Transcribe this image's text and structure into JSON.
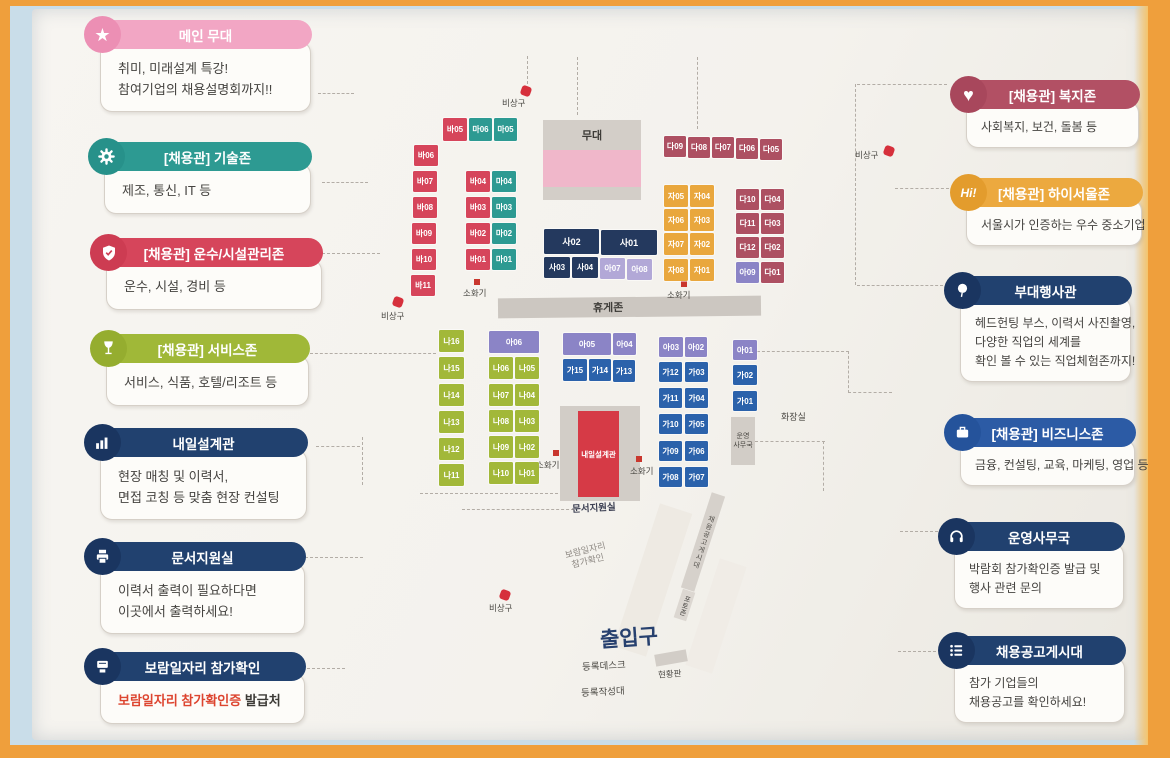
{
  "colors": {
    "frame_orange": "#ef9f3c",
    "photo_blue": "#c9dde9",
    "poster_white": "#f5f3ee",
    "pink": "#f2a6c4",
    "teal": "#2d9a92",
    "red": "#d6455b",
    "green": "#a0b838",
    "navy": "#21416f",
    "maroon": "#b25064",
    "orange": "#eca93f",
    "blue": "#2c5ba5",
    "purple": "#8b84c6",
    "light_purple": "#b2a8d7",
    "highlight_red_text": "#dd4530"
  },
  "legend_left": [
    {
      "id": "main-stage",
      "icon": "star-icon",
      "title": "메인 무대",
      "lines": [
        "취미, 미래설계 특강!",
        "참여기업의 채용설명회까지!!"
      ]
    },
    {
      "id": "tech-zone",
      "icon": "gear-icon",
      "title": "[채용관] 기술존",
      "lines": [
        "제조, 통신, IT 등"
      ]
    },
    {
      "id": "transport-facility-zone",
      "icon": "shield-check-icon",
      "title": "[채용관] 운수/시설관리존",
      "lines": [
        "운수, 시설, 경비 등"
      ]
    },
    {
      "id": "service-zone",
      "icon": "wine-glass-icon",
      "title": "[채용관] 서비스존",
      "lines": [
        "서비스, 식품, 호텔/리조트 등"
      ]
    },
    {
      "id": "tomorrow-design-hall",
      "icon": "bar-chart-icon",
      "title": "내일설계관",
      "lines": [
        "현장 매칭 및 이력서,",
        "면접 코칭 등 맞춤 현장 컨설팅"
      ]
    },
    {
      "id": "document-support-room",
      "icon": "printer-icon",
      "title": "문서지원실",
      "lines": [
        "이력서 출력이 필요하다면",
        "이곳에서 출력하세요!"
      ]
    },
    {
      "id": "boram-job-check",
      "icon": "certificate-icon",
      "title": "보람일자리 참가확인",
      "highlight": "보람일자리 참가확인증",
      "rest": " 발급처"
    }
  ],
  "legend_right": [
    {
      "id": "welfare-zone",
      "icon": "heart-icon",
      "title": "[채용관] 복지존",
      "lines": [
        "사회복지, 보건, 돌봄 등"
      ]
    },
    {
      "id": "hi-seoul-zone",
      "icon": "hi-icon",
      "title": "[채용관] 하이서울존",
      "lines": [
        "서울시가 인증하는 우수 중소기업"
      ]
    },
    {
      "id": "side-event-hall",
      "icon": "balloon-icon",
      "title": "부대행사관",
      "lines": [
        "헤드헌팅 부스, 이력서 사진촬영,",
        "다양한 직업의 세계를",
        "확인 볼 수 있는 직업체험존까지!"
      ]
    },
    {
      "id": "business-zone",
      "icon": "briefcase-icon",
      "title": "[채용관] 비즈니스존",
      "lines": [
        "금융, 컨설팅, 교육, 마케팅, 영업 등"
      ]
    },
    {
      "id": "operations-office",
      "icon": "headset-icon",
      "title": "운영사무국",
      "lines": [
        "박람회 참가확인증 발급 및",
        "행사 관련 문의"
      ]
    },
    {
      "id": "job-posting-board",
      "icon": "list-icon",
      "title": "채용공고게시대",
      "lines": [
        "참가 기업들의",
        "채용공고를 확인하세요!"
      ]
    }
  ],
  "map": {
    "stage": "무대",
    "rest_zone": "휴게존",
    "entrance": "출입구",
    "labels": {
      "emergency": "비상구",
      "fire": "소화기",
      "restroom": "화장실",
      "ops1": "운영",
      "ops2": "사무국",
      "doc_room": "문서지원실",
      "tomorrow_hall": "내일설계관",
      "boram1": "보람일자리",
      "boram2": "참가확인",
      "posting_board": "채용공고게시대",
      "photo_zone": "포토존",
      "reg_desk": "등록데스크",
      "reg_write": "등록작성대",
      "status_board": "현황판"
    },
    "booths": {
      "red_top": [
        "바05"
      ],
      "teal_top": [
        "마06",
        "마05"
      ],
      "red_col": [
        "바06",
        "바07",
        "바08",
        "바09",
        "바10",
        "바11"
      ],
      "rt_pairs": [
        "바04",
        "마04",
        "바03",
        "마03",
        "바02",
        "마02",
        "바01",
        "마01"
      ],
      "maroon_row": [
        "다09",
        "다08",
        "다07",
        "다06",
        "다05"
      ],
      "orange_grid": [
        "자05",
        "자04",
        "자06",
        "자03",
        "자07",
        "자02",
        "자08",
        "자01"
      ],
      "maroon_grid": [
        "다10",
        "다04",
        "다11",
        "다03",
        "다12",
        "다02",
        "다01"
      ],
      "purple_a09": "아09",
      "navy_wide": [
        "사02",
        "사01"
      ],
      "navy_small": [
        "사03",
        "사04"
      ],
      "purple_small": [
        "아07",
        "아08"
      ],
      "green_col": [
        "나16",
        "나15",
        "나14",
        "나13",
        "나12",
        "나11"
      ],
      "purple_a06": "아06",
      "green_pairs": [
        "나06",
        "나05",
        "나07",
        "나04",
        "나08",
        "나03",
        "나09",
        "나02",
        "나10",
        "나01"
      ],
      "purple_a05": "아05",
      "purple_a04": "아04",
      "blue_row": [
        "가15",
        "가14",
        "가13"
      ],
      "purple_a03": "아03",
      "purple_a02": "아02",
      "blue_pairs": [
        "가12",
        "가03",
        "가11",
        "가04",
        "가10",
        "가05",
        "가09",
        "가06",
        "가08",
        "가07"
      ],
      "purple_a01": "아01",
      "blue_col": [
        "가02",
        "가01"
      ]
    }
  }
}
